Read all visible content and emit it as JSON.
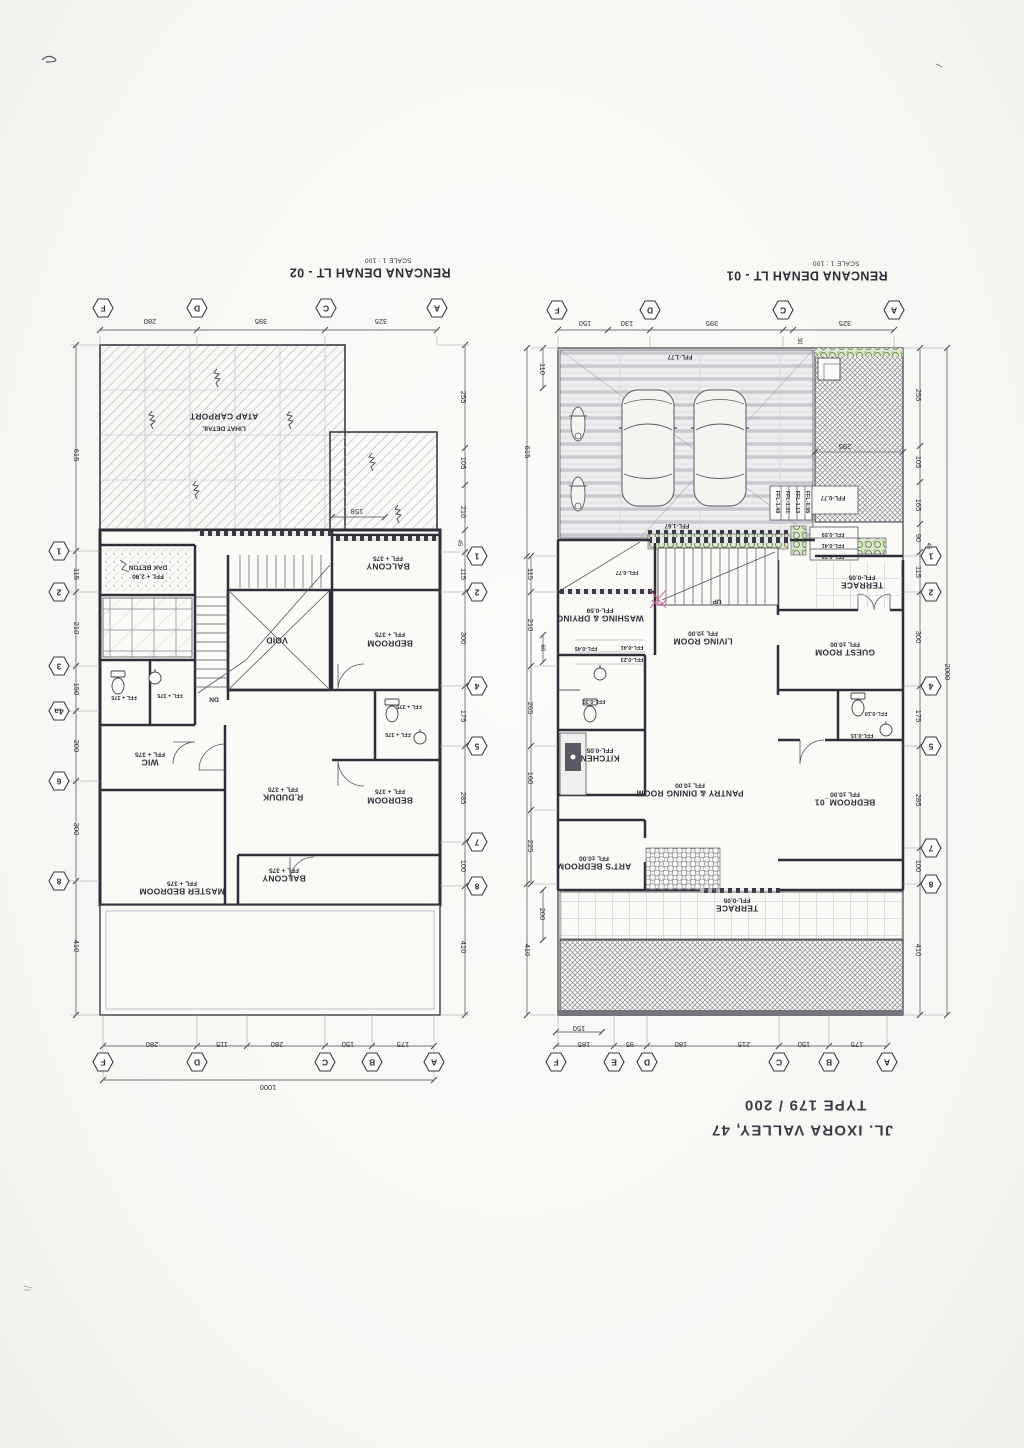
{
  "sheet": {
    "address_line": "JL. IXORA VALLEY, 47",
    "type_line": "TYPE 179 / 200"
  },
  "plan02": {
    "title": "RENCANA DENAH LT - 02",
    "scale": "SCALE 1 : 100",
    "grid_top": [
      "F",
      "D",
      "C",
      "A"
    ],
    "dims_top": [
      "280",
      "395",
      "325"
    ],
    "grid_bottom": [
      "F",
      "D",
      "C",
      "B",
      "A"
    ],
    "dims_bottom": [
      "280",
      "115",
      "280",
      "150",
      "175"
    ],
    "total_bottom": "1000",
    "grid_left": [
      "1",
      "2",
      "3",
      "4a",
      "6",
      "8"
    ],
    "dims_left": [
      "615",
      "115",
      "210",
      "150",
      "200",
      "300",
      "410"
    ],
    "grid_right": [
      "1",
      "2",
      "4",
      "5",
      "7",
      "8"
    ],
    "dims_right": [
      "255",
      "105",
      "210",
      "45",
      "115",
      "300",
      "175",
      "285",
      "100",
      "410"
    ],
    "roof_dim": "158",
    "labels": {
      "carport_roof_1": "ATAP CARPORT",
      "carport_roof_2": "LIHAT DETAIL",
      "dak_beton_1": "DAK BETON",
      "dak_beton_2": "FFL + 2.90",
      "balcony_top_1": "BALCONY",
      "balcony_top_2": "FFL + 375",
      "bedroom_top_1": "BEDROOM",
      "bedroom_top_2": "FFL + 375",
      "void": "VOID",
      "dn": "DN",
      "bath_l1": "FFL + 375",
      "bath_l2": "FFL + 375",
      "bath_r1": "FFL + 375",
      "bath_r2": "FFL + 375",
      "wic_1": "WIC",
      "wic_2": "FFL + 375",
      "rduduk_1": "R.DUDUK",
      "rduduk_2": "FFL + 375",
      "bedroom_mid_1": "BEDROOM",
      "bedroom_mid_2": "FFL + 375",
      "master_1": "MASTER BEDROOM",
      "master_2": "FFL + 375",
      "balcony_bot_1": "BALCONY",
      "balcony_bot_2": "FFL + 375"
    }
  },
  "plan01": {
    "title": "RENCANA DENAH LT - 01",
    "scale": "SCALE 1 : 100",
    "grid_top": [
      "F",
      "D",
      "C",
      "A"
    ],
    "dims_top": [
      "150",
      "130",
      "395",
      "325"
    ],
    "dim_top_small": "30",
    "grid_bottom": [
      "F",
      "E",
      "D",
      "C",
      "B",
      "A"
    ],
    "dims_bottom": [
      "185",
      "95",
      "180",
      "215",
      "150",
      "175"
    ],
    "dim_bottom_small": "150",
    "grid_right": [
      "1",
      "2",
      "4",
      "5",
      "7",
      "8"
    ],
    "dims_right": [
      "255",
      "105",
      "165",
      "90",
      "45",
      "115",
      "300",
      "175",
      "285",
      "100",
      "410"
    ],
    "total_right": "2000",
    "dims_left": [
      "110",
      "615",
      "115",
      "210",
      "60",
      "265",
      "160",
      "225",
      "200",
      "410"
    ],
    "garden_dim": "295",
    "labels": {
      "carport_high": "FFL-1.77",
      "carport_low": "FFL-1.67",
      "terrace_side_1": "TERRACE",
      "terrace_side_2": "FFL-0.05",
      "guest_1": "GUEST ROOM",
      "guest_2": "FFL ±0.00",
      "living_1": "LIVING ROOM",
      "living_2": "FFL ±0.00",
      "washing_1": "WASHING & DRYING",
      "washing_2": "FFL-0.59",
      "kitchen_1": "KITCHEN",
      "kitchen_2": "FFL-0.05",
      "pantry_1": "PANTRY & DINING ROOM",
      "pantry_2": "FFL ±0.00",
      "bedroom01_1": "BEDROOM_01",
      "bedroom01_2": "FFL ±0.00",
      "arts_1": "ART'S BEDROOM",
      "arts_2": "FFL ±0.00",
      "terrace_front_1": "TERRACE",
      "terrace_front_2": "FFL-0.05",
      "up": "UP",
      "ramp_steps": [
        "FFL-1.49",
        "FFL-1.31",
        "FFL-1.13",
        "FFL-0.95"
      ],
      "entry_landing": "FFL-0.77",
      "entry_steps": [
        "FFL-0.59",
        "FFL-0.41",
        "FFL-0.23"
      ],
      "stair_foot": "FFL-0.77",
      "hall_steps": [
        "FFL-0.45",
        "FFL-0.41",
        "FFL-0.23"
      ],
      "bath_main": "FFL-0.30",
      "bath_guest_a": "FFL-0.10",
      "bath_guest_b": "FFL-0.15"
    }
  }
}
